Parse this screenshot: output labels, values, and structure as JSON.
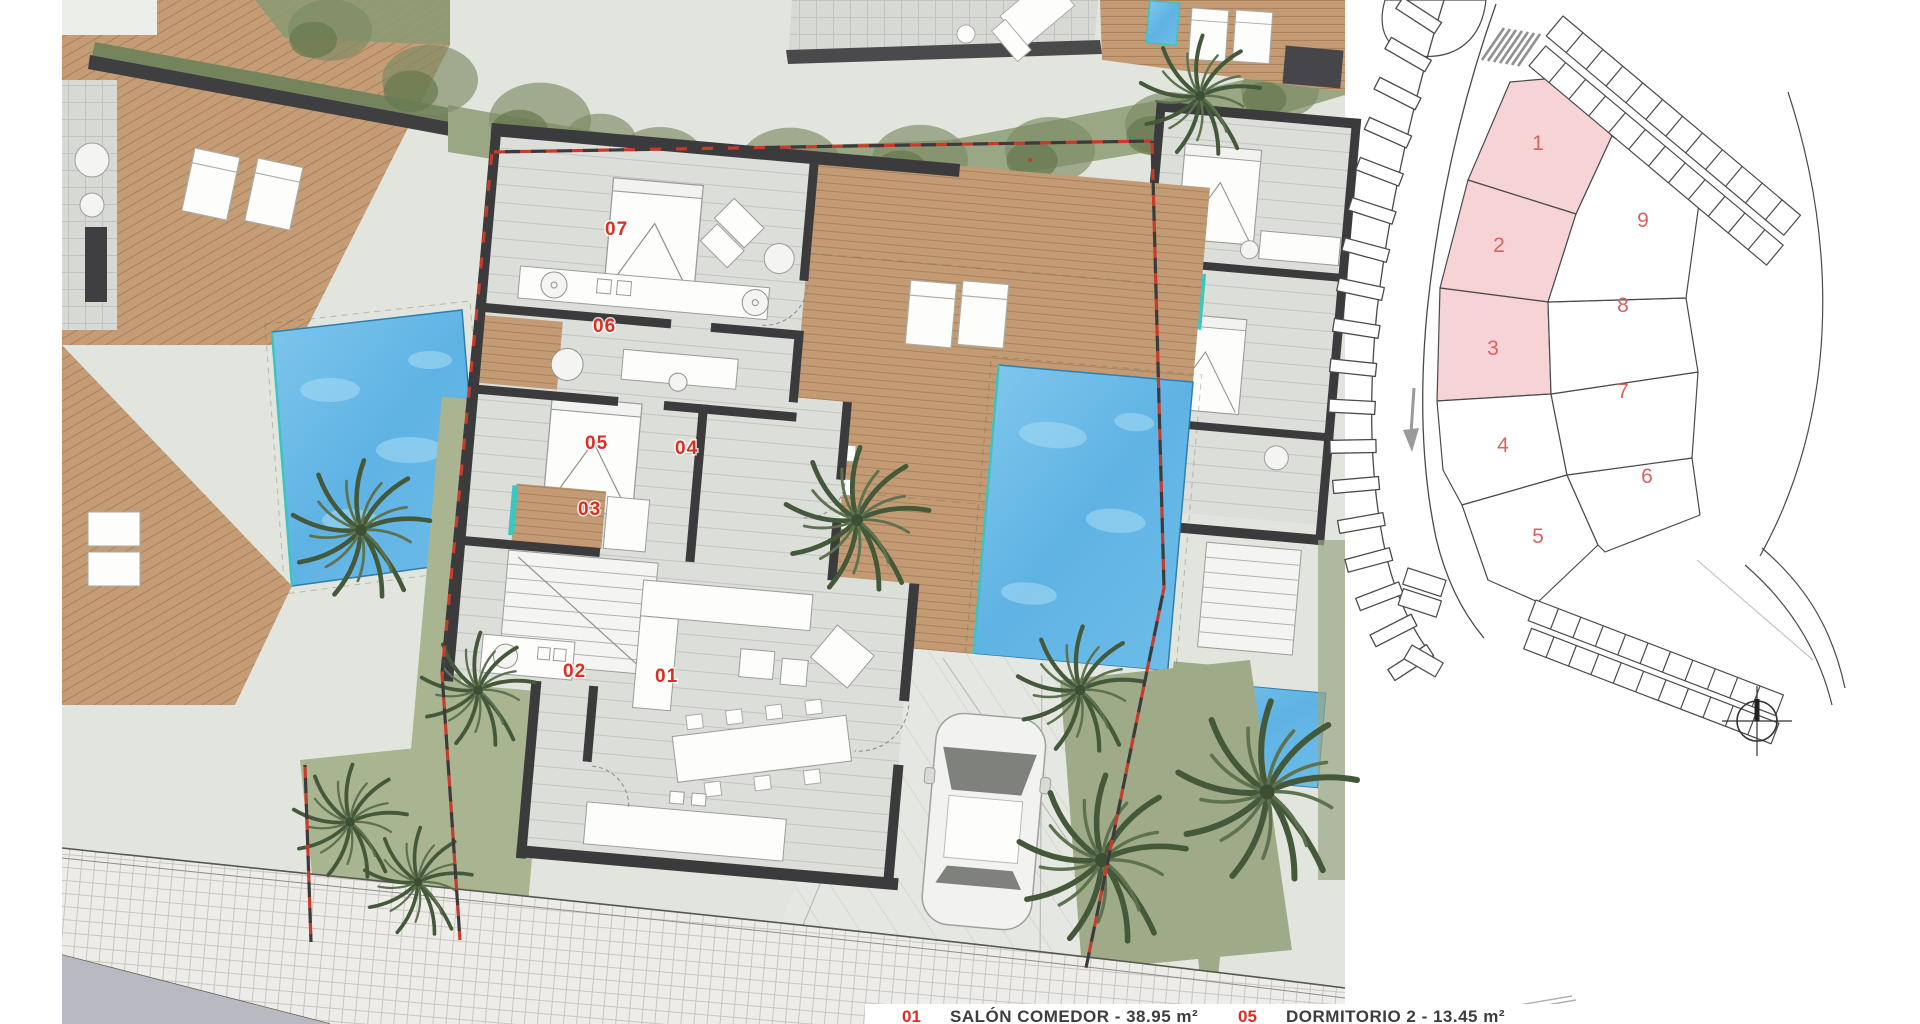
{
  "plan": {
    "room_labels": [
      "01",
      "02",
      "03",
      "04",
      "05",
      "06",
      "07"
    ]
  },
  "key_plan": {
    "plot_labels": [
      "1",
      "2",
      "3",
      "4",
      "5",
      "6",
      "7",
      "8",
      "9"
    ]
  },
  "legend": {
    "items": [
      {
        "num": "01",
        "label": "SALÓN COMEDOR - 38.95 m²"
      },
      {
        "num": "05",
        "label": "DORMITORIO 2 - 13.45 m²"
      }
    ]
  },
  "icons": {
    "compass": "north-indicator",
    "road_arrow": "direction-arrow"
  },
  "colors": {
    "room_number": "#d92f23",
    "plot_number": "#d9635f",
    "plot_highlight": "#f6d3d5",
    "pool_water": "#5fb3e4",
    "wood_deck": "#c29b74",
    "wall": "#3b3b3d",
    "boundary_red": "#c63b2a",
    "grass": "#a9b491",
    "sidewalk": "#edece8",
    "road": "#b8b9c1"
  }
}
